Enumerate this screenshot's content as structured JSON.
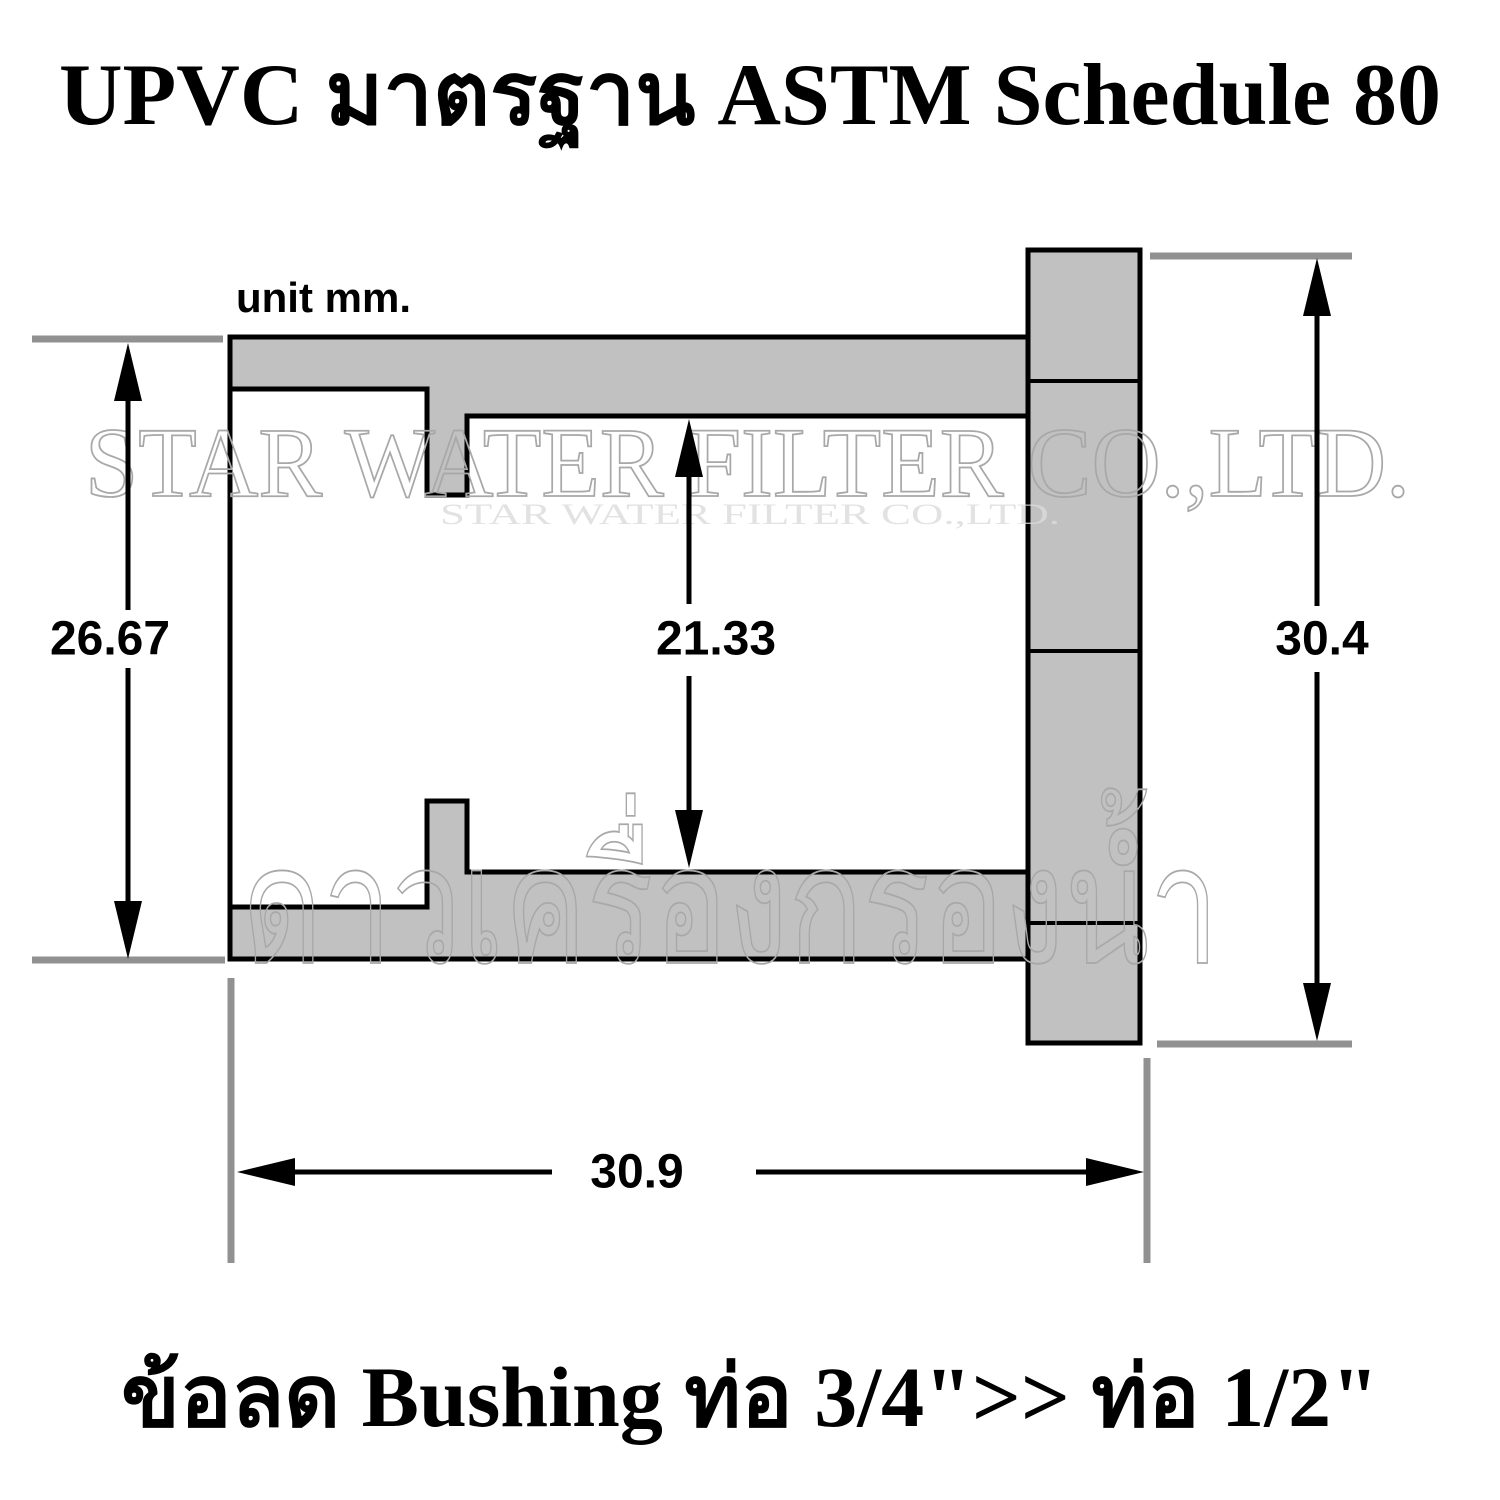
{
  "title": "UPVC มาตรฐาน ASTM Schedule 80",
  "unit_label": "unit mm.",
  "caption": "ข้อลด Bushing ท่อ 3/4\">> ท่อ 1/2\"",
  "dimensions": {
    "socket_outer_diameter": "26.67",
    "bore_diameter": "21.33",
    "flange_diameter": "30.4",
    "body_length": "30.9"
  },
  "watermark": {
    "line1": "STAR WATER FILTER CO.,LTD.",
    "line2": "ดาวเครื่องกรองน้ำ"
  },
  "colors": {
    "background": "#ffffff",
    "body_fill": "#c1c1c1",
    "outline": "#000000",
    "extension_line": "#919191",
    "watermark_stroke": "#a8a8a8",
    "text": "#000000"
  }
}
